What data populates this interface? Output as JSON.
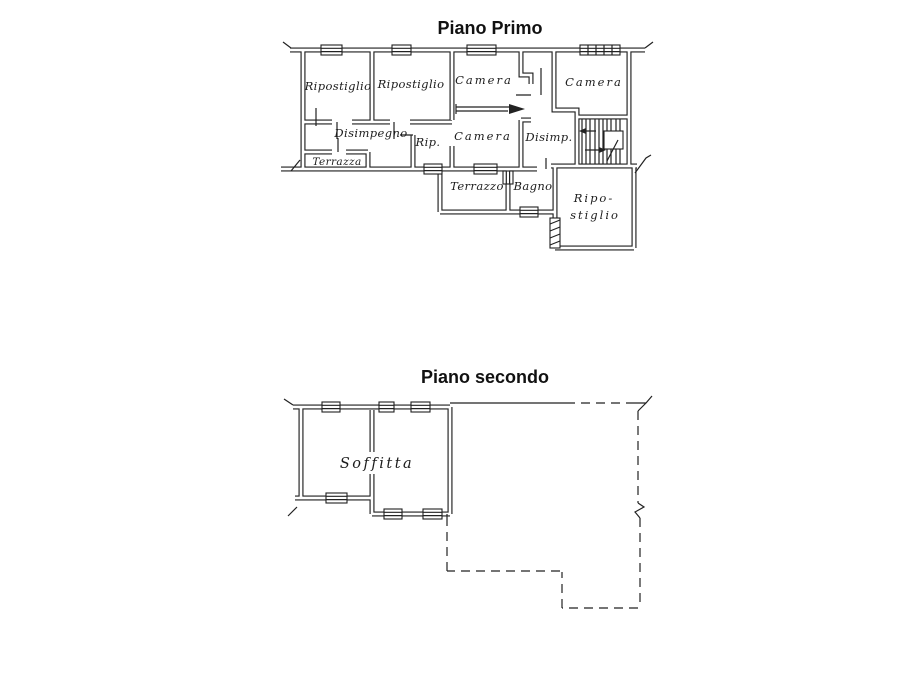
{
  "figure": {
    "background_color": "#ffffff",
    "ink_color": "#1f1f1f",
    "primo": {
      "title": "Piano Primo",
      "rooms": {
        "ripostiglio1": "Ripostiglio",
        "ripostiglio2": "Ripostiglio",
        "camera_top_mid": "Camera",
        "camera_top_right": "Camera",
        "disimpegno": "Disimpegno",
        "rip": "Rip.",
        "camera_mid": "Camera",
        "disimp": "Disimp.",
        "terrazza": "Terrazza",
        "terrazzo": "Terrazzo",
        "bagno": "Bagno",
        "ripostiglio_low_line1": "Ripo-",
        "ripostiglio_low_line2": "stiglio"
      }
    },
    "secondo": {
      "title": "Piano secondo",
      "rooms": {
        "soffitta": "Soffitta"
      }
    }
  }
}
